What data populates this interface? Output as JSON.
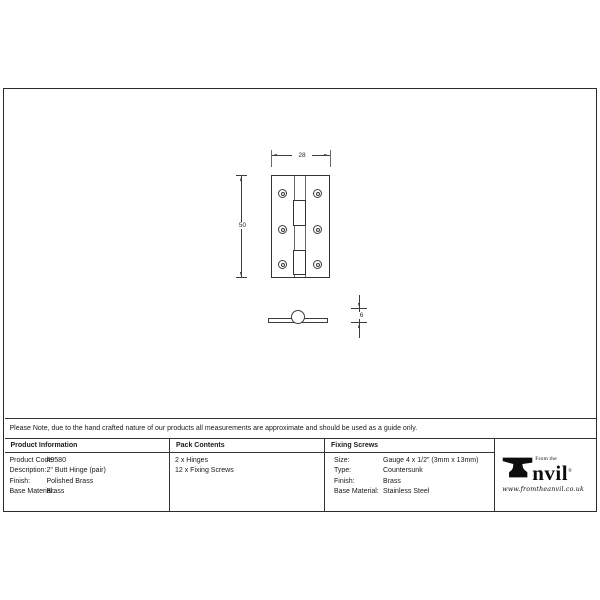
{
  "note": "Please Note, due to the hand crafted nature of our products all measurements are approximate and should be used as a guide only.",
  "drawing": {
    "dim_width": "28",
    "dim_height": "50",
    "dim_thickness": "6"
  },
  "table": {
    "product_information": {
      "header": "Product Information",
      "rows": [
        {
          "label": "Product Code:",
          "value": "49580"
        },
        {
          "label": "Description:",
          "value": "2\" Butt Hinge (pair)"
        },
        {
          "label": "Finish:",
          "value": "Polished Brass"
        },
        {
          "label": "Base Material:",
          "value": "Brass"
        }
      ]
    },
    "pack_contents": {
      "header": "Pack Contents",
      "items": [
        "2 x Hinges",
        "12 x Fixing Screws"
      ]
    },
    "fixing_screws": {
      "header": "Fixing Screws",
      "rows": [
        {
          "label": "Size:",
          "value": "Gauge 4 x 1/2\" (3mm x 13mm)"
        },
        {
          "label": "Type:",
          "value": "Countersunk"
        },
        {
          "label": "Finish:",
          "value": "Brass"
        },
        {
          "label": "Base Material:",
          "value": "Stainless Steel"
        }
      ]
    }
  },
  "logo": {
    "tagline": "From the",
    "name_rest": "nvil",
    "registered": "®",
    "website": "www.fromtheanvil.co.uk"
  },
  "colors": {
    "frame_border": "#2b2b2b",
    "table_line": "#333333",
    "drawing_line": "#3d3d3d",
    "text": "#1a1a1a",
    "logo": "#0d0d0d"
  }
}
